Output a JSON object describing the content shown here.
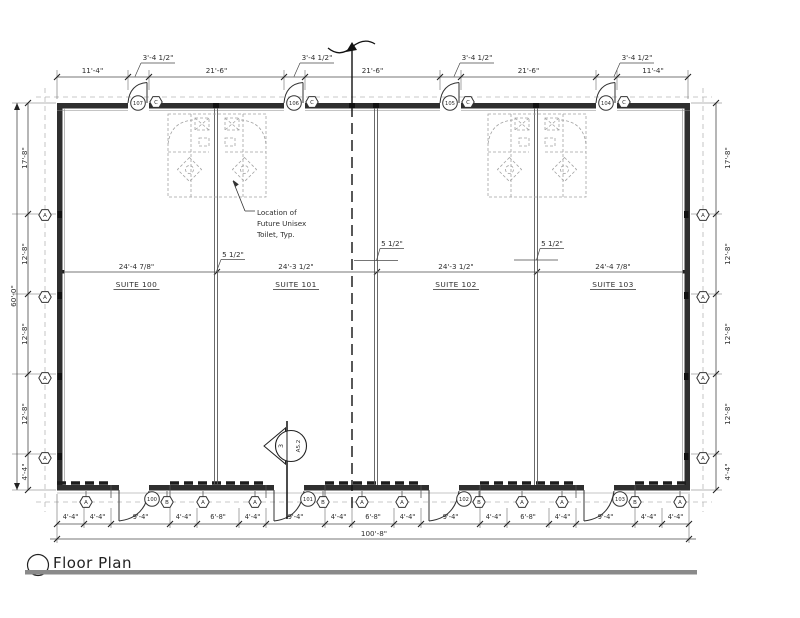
{
  "title": {
    "label": "Floor Plan"
  },
  "suites": [
    {
      "name": "SUITE 100",
      "width": "24'-4 7/8\""
    },
    {
      "name": "SUITE 101",
      "width": "24'-3 1/2\""
    },
    {
      "name": "SUITE 102",
      "width": "24'-3 1/2\""
    },
    {
      "name": "SUITE 103",
      "width": "24'-4 7/8\""
    }
  ],
  "dims": {
    "top": [
      "11'-4\"",
      "21'-6\"",
      "21'-6\"",
      "21'-6\"",
      "11'-4\""
    ],
    "top_door_width": "3'-4 1/2\"",
    "left": [
      "17'-8\"",
      "12'-8\"",
      "12'-8\"",
      "12'-8\"",
      "4'-4\""
    ],
    "left_overall": "60'-0\"",
    "right": [
      "17'-8\"",
      "12'-8\"",
      "12'-8\"",
      "12'-8\"",
      "4'-4\""
    ],
    "bottom": [
      "4'-4\"",
      "4'-4\"",
      "9'-4\"",
      "4'-4\"",
      "6'-8\"",
      "4'-4\"",
      "9'-4\"",
      "4'-4\"",
      "6'-8\"",
      "4'-4\"",
      "9'-4\"",
      "4'-4\"",
      "6'-8\"",
      "4'-4\"",
      "9'-4\"",
      "4'-4\"",
      "4'-4\""
    ],
    "bottom_overall": "100'-8\"",
    "wall_thickness": "5 1/2\""
  },
  "door_tags": {
    "top": [
      "107",
      "106",
      "105",
      "104"
    ],
    "bottom": [
      "100",
      "101",
      "102",
      "103"
    ]
  },
  "wall_tags": {
    "a": "A",
    "b": "B",
    "c": "C"
  },
  "annotation": {
    "line1": "Location of",
    "line2": "Future Unisex",
    "line3": "Toilet, Typ."
  },
  "section_marker": {
    "number": "3",
    "sheet": "A5.2"
  },
  "colors": {
    "line": "#2e2e2e",
    "wall": "#2f2f2f",
    "dashed_ref": "#b8b8b8",
    "future_work": "#a3a3a3",
    "title_bar": "#8a8a8a"
  }
}
